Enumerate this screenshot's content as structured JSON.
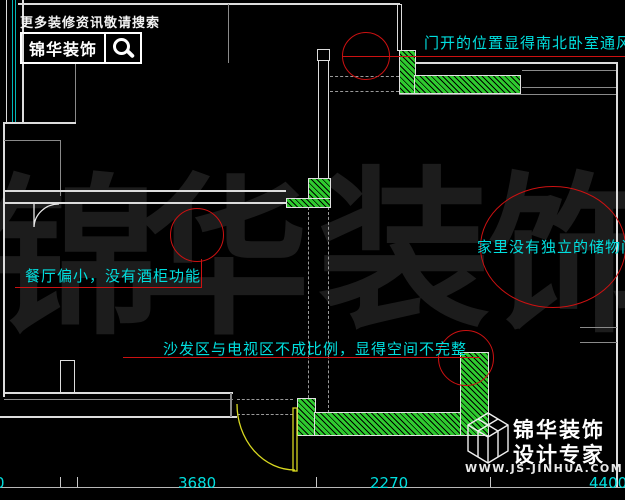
{
  "top_logo": {
    "tagline": "更多装修资讯敬请搜索",
    "brand": "锦华装饰",
    "search_icon": "magnifier-icon"
  },
  "watermark": {
    "chars": [
      "锦",
      "华",
      "装",
      "饰"
    ]
  },
  "annotations": [
    {
      "text": "门开的位置显得南北卧室通风不好"
    },
    {
      "text": "餐厅偏小，没有酒柜功能"
    },
    {
      "text": "家里没有独立的储物间"
    },
    {
      "text": "沙发区与电视区不成比例，显得空间不完整"
    }
  ],
  "dimensions": {
    "left_partial": "0",
    "d1": "3680",
    "d2": "2270",
    "d3": "4400"
  },
  "bottom_logo": {
    "brand": "锦华装饰",
    "subtitle": "设计专家",
    "website": "WWW.JS-JINHUA.COM"
  },
  "colors": {
    "annotation_cyan": "#00DFDF",
    "markup_red": "#CC1111",
    "hatch_green": "#2FCB2F",
    "wall_white": "#DCDCDC",
    "door_yellow": "#D8D820",
    "balcony_cyan": "#00B8B8",
    "watermark_gray": "#1C1C1C"
  }
}
